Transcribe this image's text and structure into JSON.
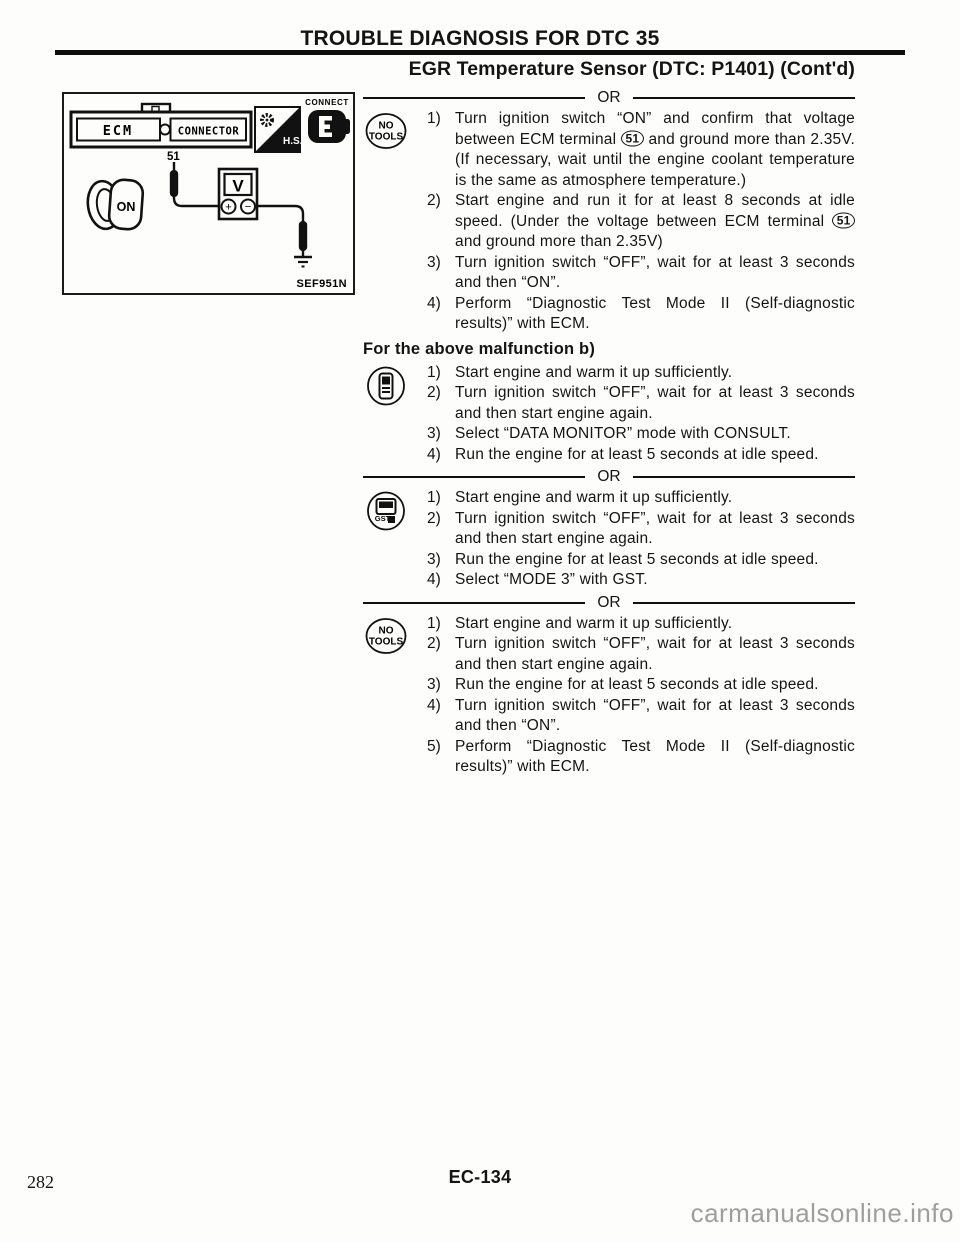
{
  "page": {
    "header_title": "TROUBLE DIAGNOSIS FOR DTC 35",
    "section_title": "EGR Temperature Sensor (DTC: P1401) (Cont'd)",
    "or_label": "OR",
    "malfunction_heading": "For the above malfunction b)",
    "page_number": "282",
    "page_code": "EC-134",
    "watermark": "carmanualsonline.info"
  },
  "diagram": {
    "figure_code": "SEF951N",
    "ecm_label": "ECM",
    "connector_label": "CONNECTOR",
    "terminal_number": "51",
    "hs_label": "H.S.",
    "connect_label": "CONNECT",
    "ignition_key_label": "ON",
    "voltmeter_label": "V",
    "plus_label": "+",
    "minus_label": "−"
  },
  "sections": [
    {
      "icon": "no-tools",
      "icon_line1": "NO",
      "icon_line2": "TOOLS",
      "steps": [
        {
          "num": "1)",
          "pre": "Turn ignition switch “ON” and confirm that voltage between ECM terminal ",
          "term": "51",
          "post": " and ground more than 2.35V. (If necessary, wait until the engine coolant temperature is the same as atmosphere temperature.)"
        },
        {
          "num": "2)",
          "pre": "Start engine and run it for at least 8 seconds at idle speed. (Under the voltage between ECM terminal ",
          "term": "51",
          "post": " and ground more than 2.35V)"
        },
        {
          "num": "3)",
          "text": "Turn ignition switch “OFF”, wait for at least 3 seconds and then “ON”."
        },
        {
          "num": "4)",
          "text": "Perform “Diagnostic Test Mode II (Self-diagnostic results)” with ECM."
        }
      ]
    },
    {
      "icon": "consult",
      "steps": [
        {
          "num": "1)",
          "text": "Start engine and warm it up sufficiently."
        },
        {
          "num": "2)",
          "text": "Turn ignition switch “OFF”, wait for at least 3 seconds and then start engine again."
        },
        {
          "num": "3)",
          "text": "Select “DATA MONITOR” mode with CONSULT."
        },
        {
          "num": "4)",
          "text": "Run the engine for at least 5 seconds at idle speed."
        }
      ]
    },
    {
      "icon": "gst",
      "icon_label": "GST",
      "steps": [
        {
          "num": "1)",
          "text": "Start engine and warm it up sufficiently."
        },
        {
          "num": "2)",
          "text": "Turn ignition switch “OFF”, wait for at least 3 seconds and then start engine again."
        },
        {
          "num": "3)",
          "text": "Run the engine for at least 5 seconds at idle speed."
        },
        {
          "num": "4)",
          "text": "Select “MODE 3” with GST."
        }
      ]
    },
    {
      "icon": "no-tools",
      "icon_line1": "NO",
      "icon_line2": "TOOLS",
      "steps": [
        {
          "num": "1)",
          "text": "Start engine and warm it up sufficiently."
        },
        {
          "num": "2)",
          "text": "Turn ignition switch “OFF”, wait for at least 3 seconds and then start engine again."
        },
        {
          "num": "3)",
          "text": "Run the engine for at least 5 seconds at idle speed."
        },
        {
          "num": "4)",
          "text": "Turn ignition switch “OFF”, wait for at least 3 seconds and then “ON”."
        },
        {
          "num": "5)",
          "text": "Perform “Diagnostic Test Mode II (Self-diagnostic results)” with ECM."
        }
      ]
    }
  ]
}
